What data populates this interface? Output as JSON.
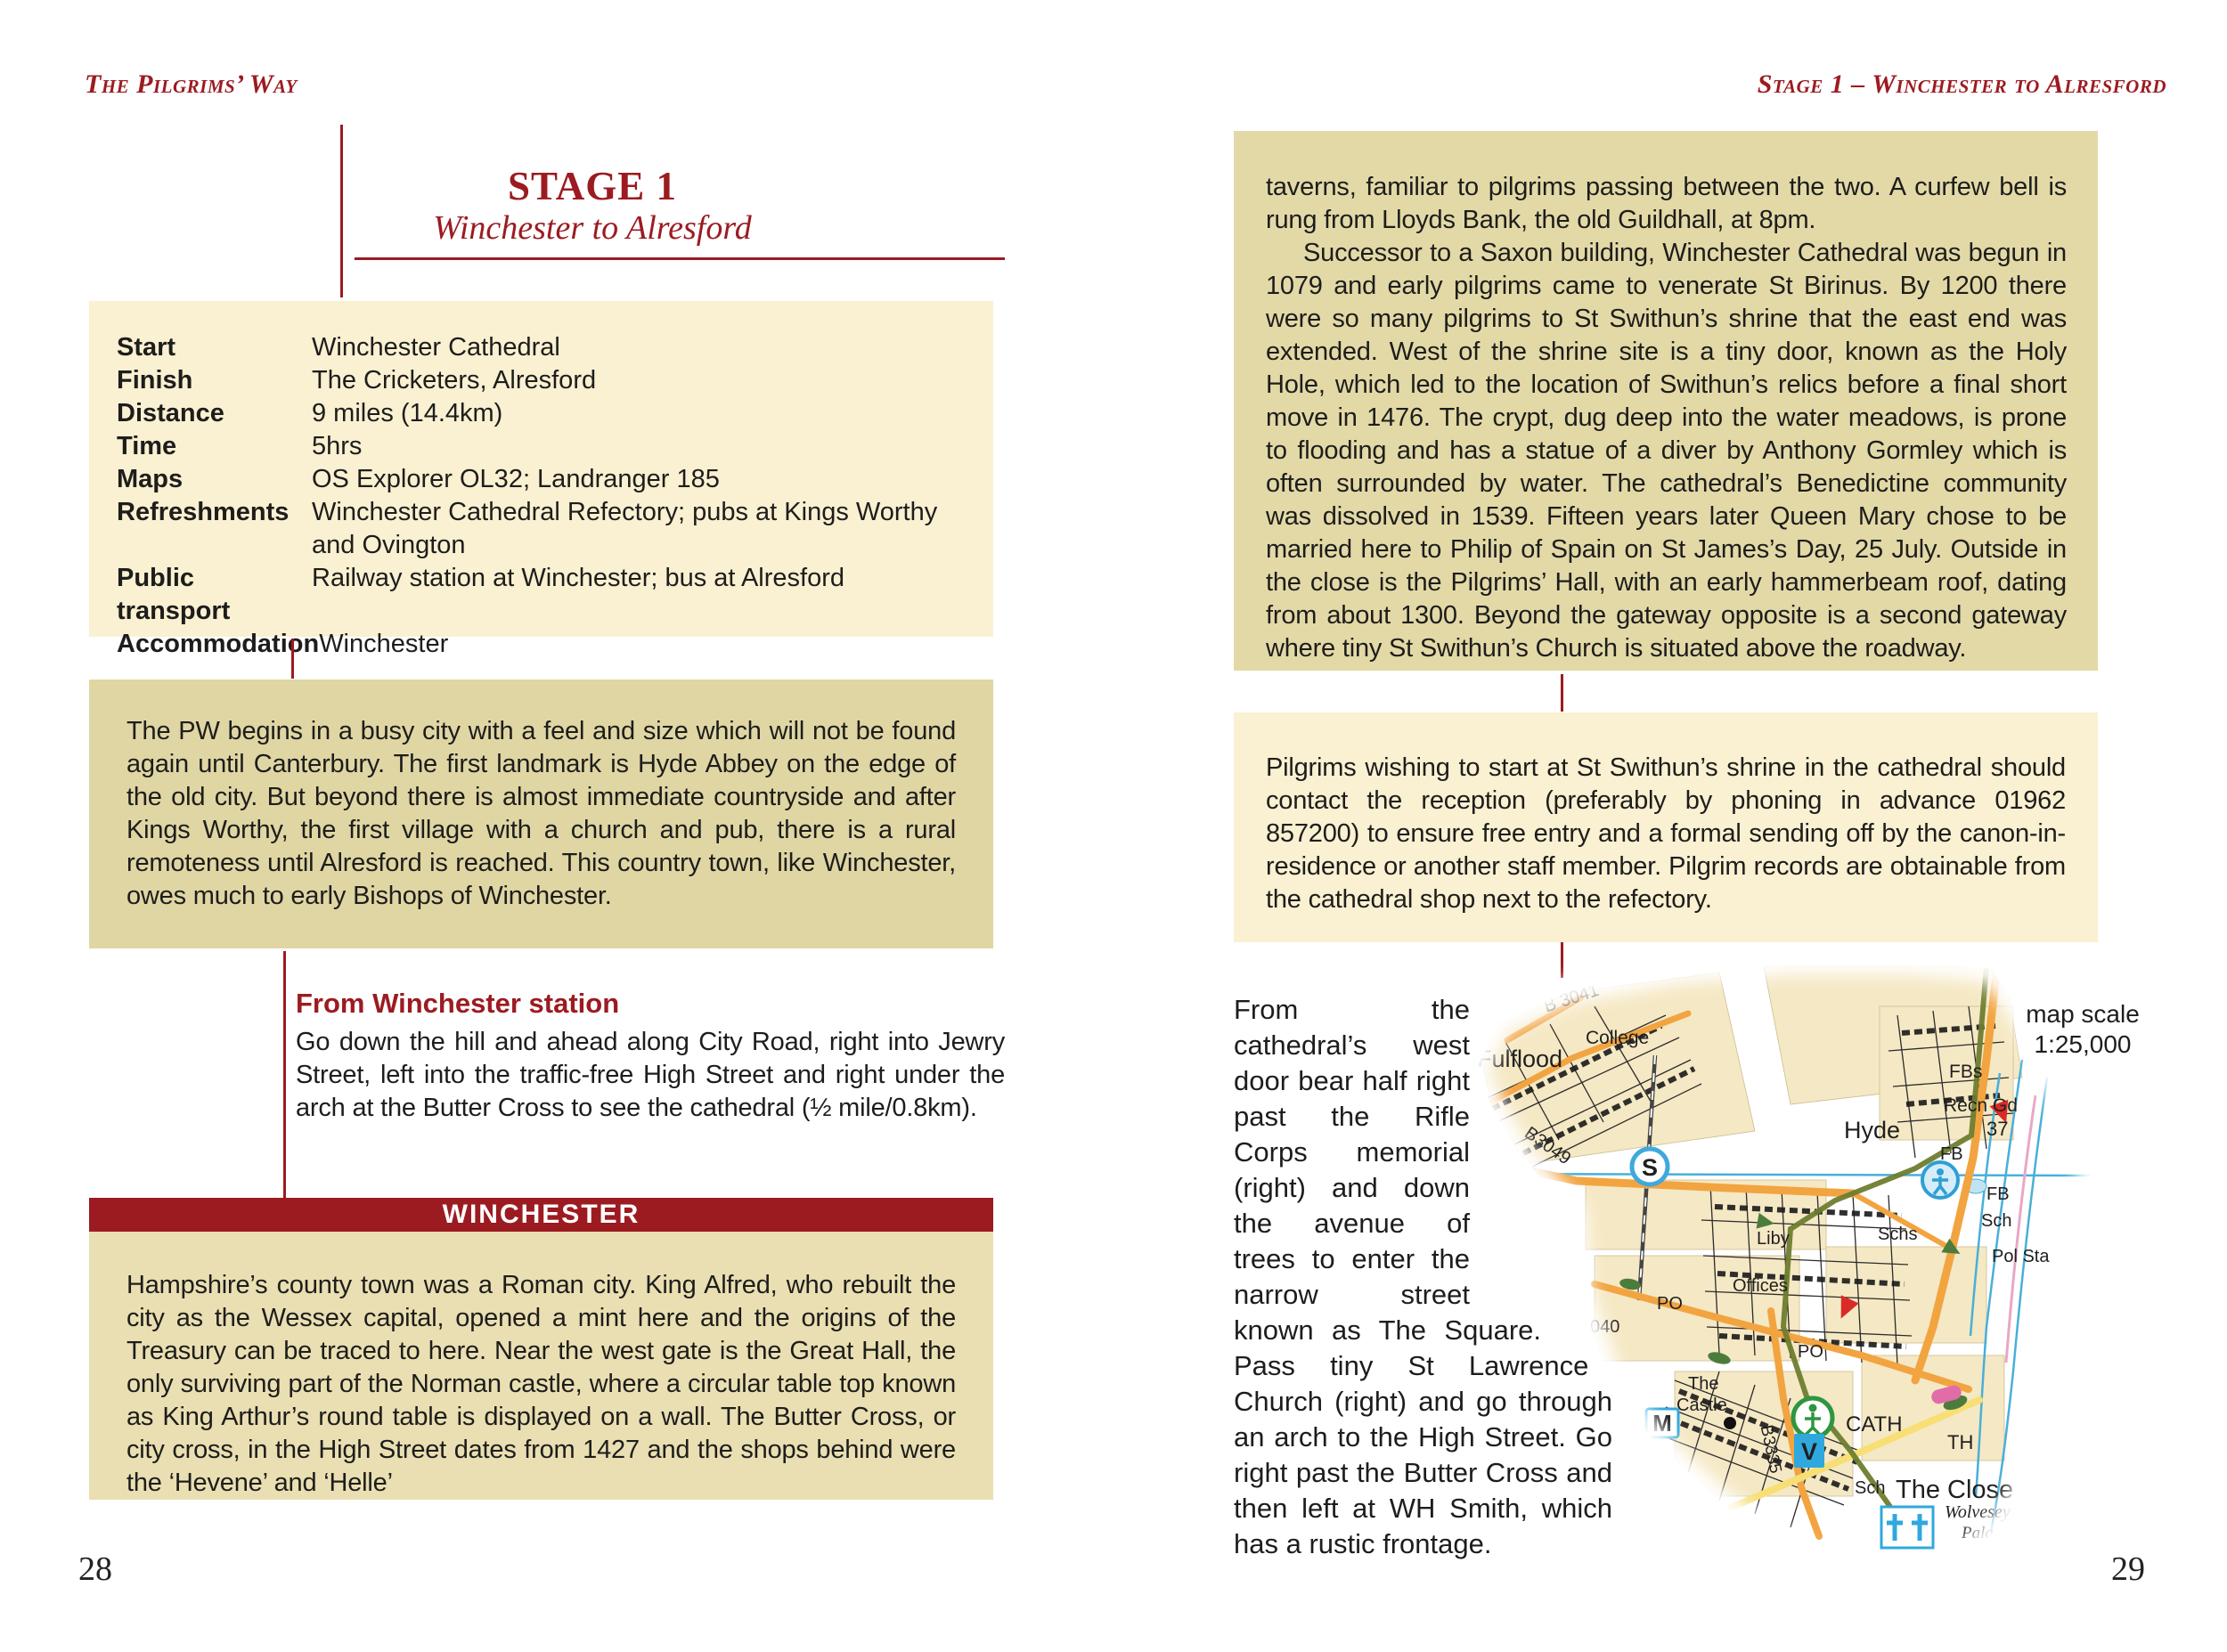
{
  "book": {
    "left_header": "The Pilgrims’ Way",
    "right_header": "Stage 1 – Winchester to Alresford",
    "left_page_number": "28",
    "right_page_number": "29"
  },
  "stage": {
    "title": "STAGE 1",
    "subtitle": "Winchester to Alresford"
  },
  "info": {
    "rows": [
      {
        "label": "Start",
        "value": "Winchester Cathedral"
      },
      {
        "label": "Finish",
        "value": "The Cricketers, Alresford"
      },
      {
        "label": "Distance",
        "value": "9 miles (14.4km)"
      },
      {
        "label": "Time",
        "value": "5hrs"
      },
      {
        "label": "Maps",
        "value": "OS Explorer OL32; Landranger 185"
      },
      {
        "label": "Refreshments",
        "value": "Winchester Cathedral Refectory; pubs at Kings Worthy and Ovington"
      },
      {
        "label": "Public transport",
        "value": "Railway station at Winchester; bus at Alresford"
      },
      {
        "label": "Accommodation",
        "value": "Winchester"
      }
    ]
  },
  "intro": {
    "text": "The PW begins in a busy city with a feel and size which will not be found again until Canterbury. The first landmark is Hyde Abbey on the edge of the old city. But beyond there is almost immediate countryside and after Kings Worthy, the first village with a church and pub, there is a rural remoteness until Alresford is reached. This country town, like Winchester, owes much to early Bishops of Winchester."
  },
  "station_section": {
    "heading": "From Winchester station",
    "text": "Go down the hill and ahead along City Road, right into Jewry Street, left into the traffic-free High Street and right under the arch at the Butter Cross to see the cathedral (½ mile/0.8km)."
  },
  "winchester": {
    "banner": "WINCHESTER",
    "text": "Hampshire’s county town was a Roman city. King Alfred, who rebuilt the city as the Wessex capital, opened a mint here and the origins of the Treasury can be traced to here. Near the west gate is the Great Hall, the only surviving part of the Norman castle, where a circular table top known as King Arthur’s round table is displayed on a wall. The Butter Cross, or city cross, in the High Street dates from 1427 and the shops behind were the ‘Hevene’ and ‘Helle’"
  },
  "page2": {
    "para1": "taverns, familiar to pilgrims passing between the two. A curfew bell is rung from Lloyds Bank, the old Guildhall, at 8pm.",
    "para2": "Successor to a Saxon building, Winchester Cathedral was begun in 1079 and early pilgrims came to venerate St Birinus. By 1200 there were so many pilgrims to St Swithun’s shrine that the east end was extended. West of the shrine site is a tiny door, known as the Holy Hole, which led to the location of Swithun’s relics before a final short move in 1476. The crypt, dug deep into the water meadows, is prone to flooding and has a statue of a diver by Anthony Gormley which is often surrounded by water. The cathedral’s Benedictine community was dissolved in 1539. Fifteen years later Queen Mary chose to be married here to Philip of Spain on St James’s Day, 25 July. Outside in the close is the Pilgrims’ Hall, with an early hammerbeam roof, dating from about 1300. Beyond the gateway opposite is a second gateway where tiny St Swithun’s Church is situated above the roadway.",
    "pilgrims_box": "Pilgrims wishing to start at St Swithun’s shrine in the cathedral should contact the reception (preferably by phoning in advance 01962 857200) to ensure free entry and a formal sending off by the canon-in-residence or another staff member. Pilgrim records are obtainable from the cathedral shop next to the refectory.",
    "route_text": "From the cathedral’s west door bear half right past the Rifle Corps memorial (right) and down the avenue of trees to enter the narrow street known as The Square. Pass tiny St Lawrence Church (right) and go through an arch to the High Street. Go right past the Butter Cross and then left at WH Smith, which has a rustic frontage."
  },
  "map": {
    "scale_label": "map scale",
    "scale_value": "1:25,000",
    "labels": {
      "fulflood": "Fulflood",
      "college": "College",
      "b3041": "B 3041",
      "b3049": "B3049",
      "hyde": "Hyde",
      "fbs": "FBs",
      "recn_gd": "Recn Gd",
      "n37": "37",
      "fb1": "FB",
      "fb2": "FB",
      "sch1": "Sch",
      "schs": "Schs",
      "pol_sta": "Pol Sta",
      "liby": "Liby",
      "offices": "Offices",
      "po1": "PO",
      "po2": "PO",
      "n040": "040",
      "the": "The",
      "castle": "Castle",
      "b3335": "B3335",
      "cath": "CATH",
      "th": "TH",
      "sch2": "Sch",
      "the_close": "The Close",
      "wolvesey": "Wolvesey",
      "palace": "Palace",
      "station_s": "S",
      "museum_m": "M",
      "museum_v": "V"
    },
    "colors": {
      "accent_red": "#9c1b21",
      "box_cream": "#faf0d2",
      "box_tan": "#e0d6a4",
      "road_orange": "#f2a441",
      "road_yellow": "#f7df76",
      "water_blue": "#49afd9",
      "route_green": "#6e7d2e"
    }
  }
}
